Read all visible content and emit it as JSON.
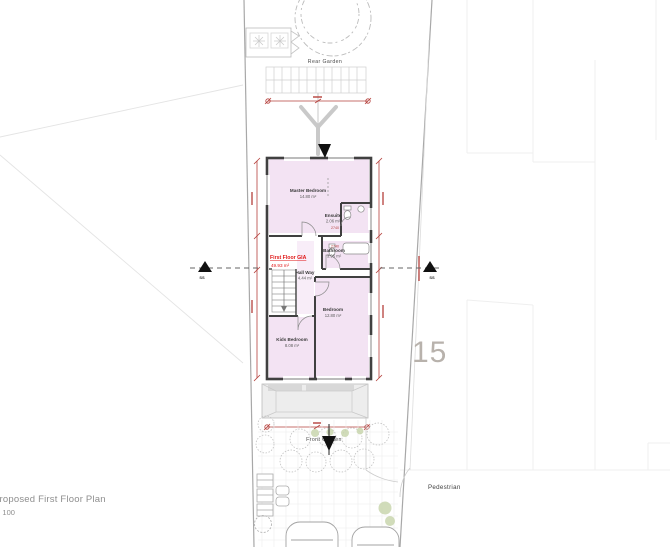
{
  "title_block": {
    "title": "Proposed First Floor Plan",
    "scale": "1 : 100"
  },
  "site_labels": {
    "rear_garden": "Rear Garden",
    "front_garden": "Front Garden",
    "pedestrian": "Pedestrian",
    "house_number": "15",
    "section_marker": "SS"
  },
  "plan": {
    "gia": {
      "label": "First Floor GIA",
      "area": "49.93 m²"
    },
    "rooms": [
      {
        "name": "Master Bedroom",
        "area": "14.80 m²"
      },
      {
        "name": "Ensuite",
        "area": "2.06 m²"
      },
      {
        "name": "Bathroom",
        "area": "3.95 m²"
      },
      {
        "name": "Hall Way",
        "area": "4.44 m²"
      },
      {
        "name": "Bedroom",
        "area": "12.80 m²"
      },
      {
        "name": "Kids Bedroom",
        "area": "8.08 m²"
      }
    ],
    "dimensions": [
      "2740",
      "2740"
    ]
  },
  "colors": {
    "room_fill": "#f3e3f3",
    "wall": "#404040",
    "dimension_red": "#b5403c",
    "gia_red": "#e01818",
    "site_line_gray": "#a8a8a8",
    "faint_gray": "#ededed",
    "planting_green": "#c9d6ae"
  }
}
